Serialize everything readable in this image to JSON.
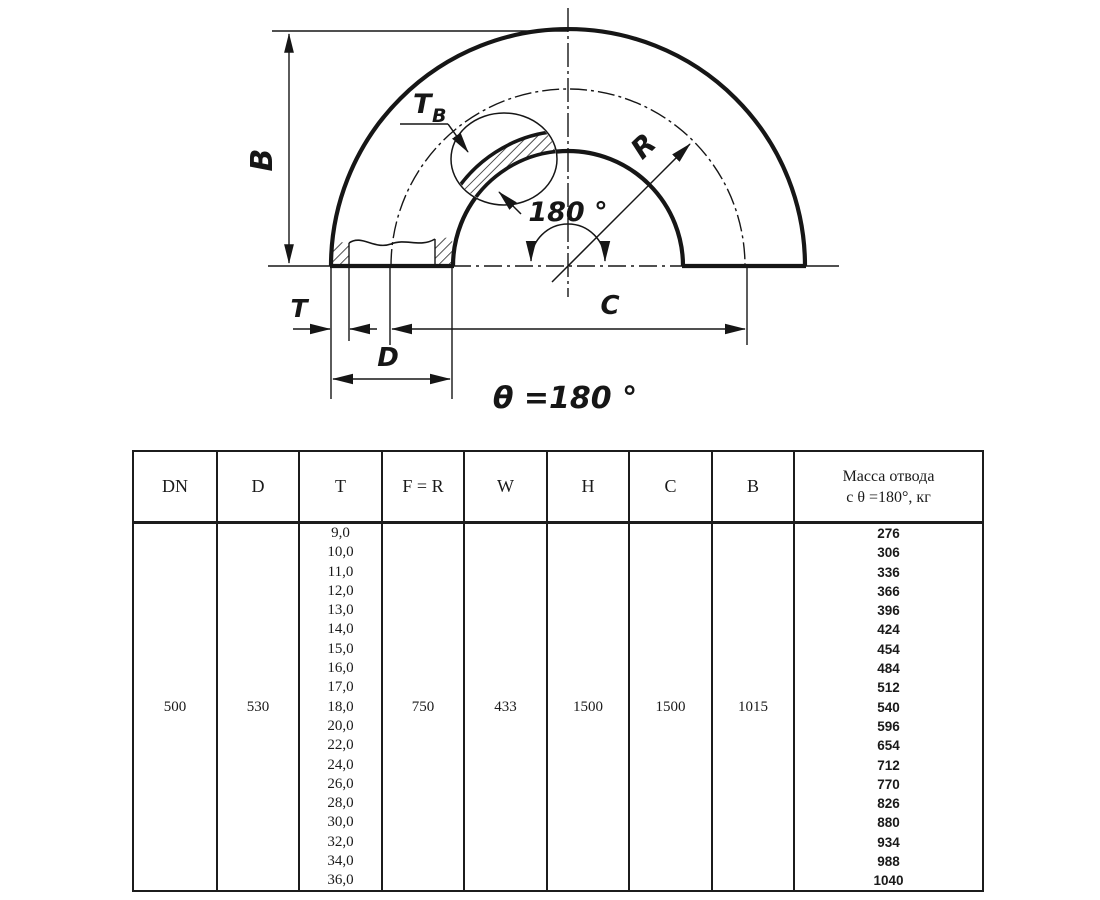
{
  "drawing": {
    "labels": {
      "b_dim": "B",
      "t_wall": "T",
      "t_wall_sub": "B",
      "radius": "R",
      "angle_arc": "180 °",
      "t_dim": "T",
      "d_dim": "D",
      "c_dim": "C",
      "theta_caption": "θ =180 °"
    },
    "line_color": "#161616"
  },
  "table": {
    "headers": [
      "DN",
      "D",
      "T",
      "F = R",
      "W",
      "H",
      "C",
      "B"
    ],
    "mass_header": {
      "line1": "Масса отвода",
      "line2": "с θ =180°, кг"
    },
    "row": {
      "dn": "500",
      "d": "530",
      "t_values": [
        "9,0",
        "10,0",
        "11,0",
        "12,0",
        "13,0",
        "14,0",
        "15,0",
        "16,0",
        "17,0",
        "18,0",
        "20,0",
        "22,0",
        "24,0",
        "26,0",
        "28,0",
        "30,0",
        "32,0",
        "34,0",
        "36,0"
      ],
      "f_r": "750",
      "w": "433",
      "h": "1500",
      "c": "1500",
      "b": "1015",
      "mass_values": [
        "276",
        "306",
        "336",
        "366",
        "396",
        "424",
        "454",
        "484",
        "512",
        "540",
        "596",
        "654",
        "712",
        "770",
        "826",
        "880",
        "934",
        "988",
        "1040"
      ]
    }
  }
}
